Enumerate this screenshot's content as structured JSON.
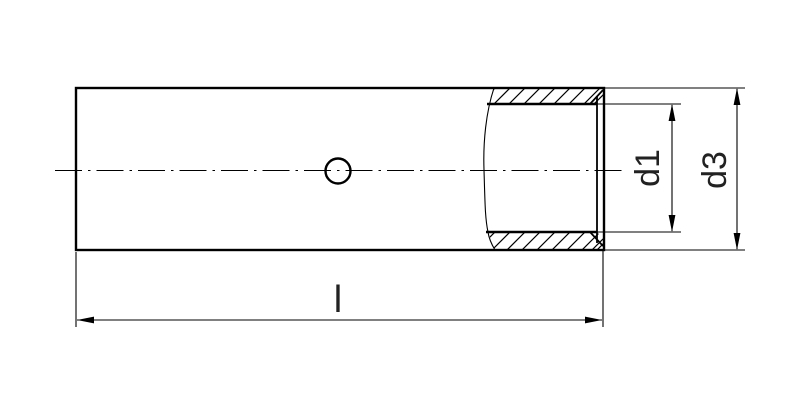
{
  "drawing": {
    "background_color": "#ffffff",
    "stroke_color": "#000000",
    "labels": {
      "inner_diameter": "d1",
      "outer_diameter": "d3",
      "overall_length": "l"
    }
  }
}
